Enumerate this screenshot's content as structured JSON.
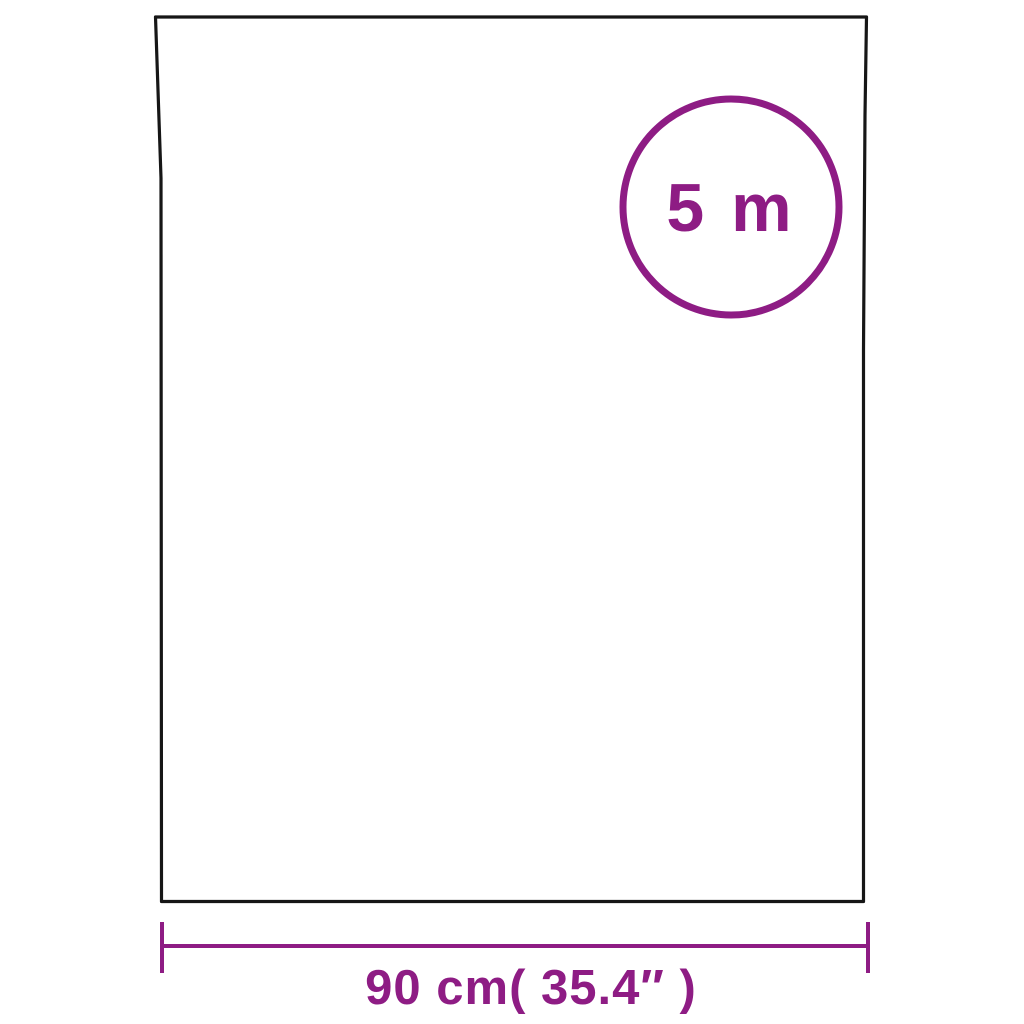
{
  "diagram": {
    "kind": "product-dimension-diagram",
    "badge": {
      "label": "5 m"
    },
    "width_dimension": {
      "label": "90 cm( 35.4″ )"
    }
  },
  "colors": {
    "accent": "#8E1C84",
    "outline": "#161616",
    "background": "#FFFFFF"
  }
}
